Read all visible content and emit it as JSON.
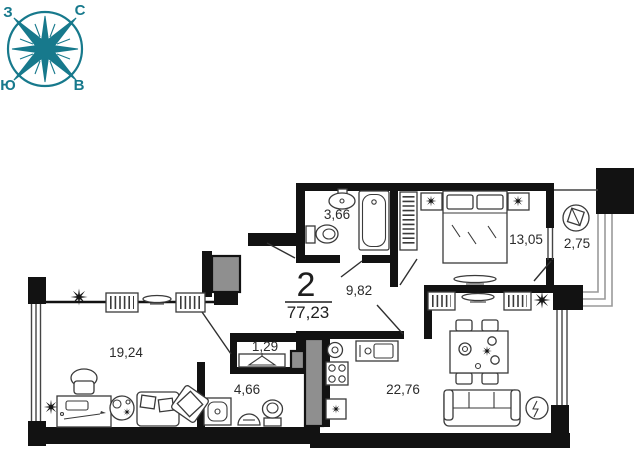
{
  "compass": {
    "north": "С",
    "south": "Ю",
    "west": "З",
    "east": "В"
  },
  "apartment": {
    "number": "2",
    "total_area": "77,23"
  },
  "areas": {
    "bathroom": "3,66",
    "hallway": "9,82",
    "bedroom": "13,05",
    "balcony": "2,75",
    "living_room": "19,24",
    "closet": "1,29",
    "bathroom_2": "4,66",
    "kitchen_living": "22,76"
  },
  "icons": {
    "compass-rose": "8-point star in circle",
    "bed": "double bed with two pillows",
    "bathtub": "rectangular tub",
    "toilet": "bowl with tank",
    "sink": "oval basin",
    "shower": "square tray",
    "stove": "4-burner hob",
    "kitchen-sink": "counter basin",
    "washing-machine": "circle drum",
    "fridge": "square box",
    "wardrobe": "rail with hangers",
    "tv": "flat lens on stand",
    "sofa": "couch with cushions",
    "armchair": "tilted seat",
    "desk": "table with pencil",
    "office-chair": "round back chair",
    "dining-table": "table with four chairs",
    "ceiling-light": "black burst star",
    "plant": "small star",
    "hanger": "clothes hanger",
    "balcony-chair": "round chair"
  },
  "colors": {
    "compass": "#17798c",
    "walls": "#121212",
    "shaft": "#8f8f8f"
  }
}
